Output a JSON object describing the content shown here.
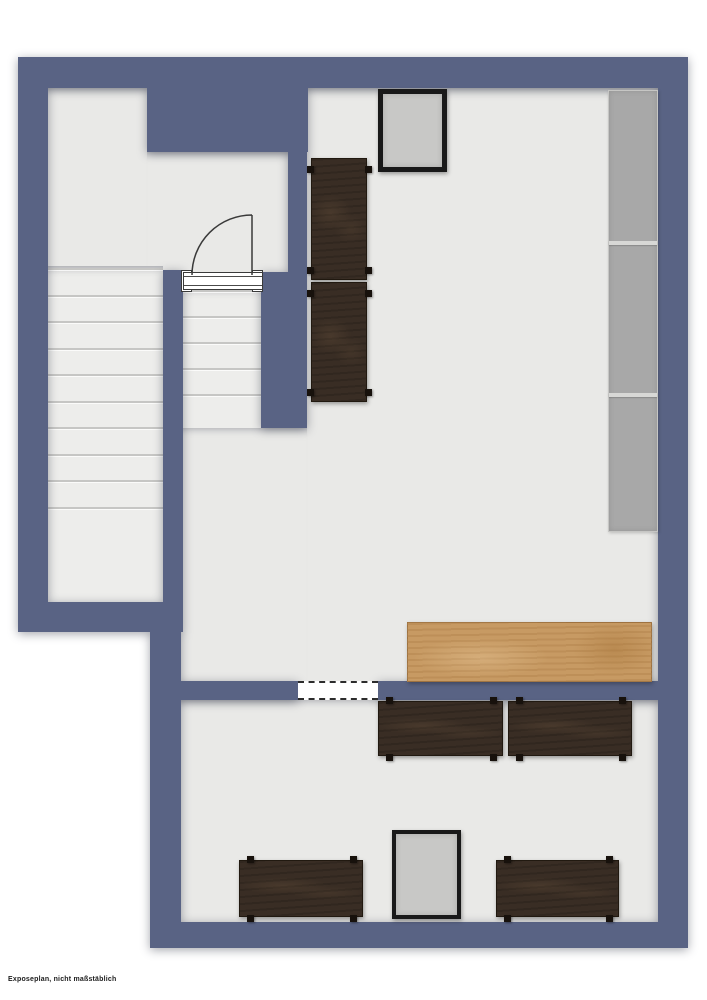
{
  "plan": {
    "disclaimer": "Exposeplan, nicht maßstäblich",
    "colors": {
      "wall": "#596384",
      "floor": "#e9e9e7",
      "stair": "#ededeb",
      "tread": "#c6c6c4",
      "shelf": "#a8a8a8",
      "darkwood": "#392d24",
      "lightwood": "#c79a63",
      "frameblack": "#191919",
      "framefill": "#c8c8c6"
    },
    "floors": [
      {
        "name": "floor-upper-left-room",
        "x": 45,
        "y": 88,
        "w": 102,
        "h": 184
      },
      {
        "name": "floor-upper-left-room-right",
        "x": 147,
        "y": 152,
        "w": 141,
        "h": 120
      },
      {
        "name": "floor-main-room",
        "x": 307,
        "y": 88,
        "w": 351,
        "h": 594
      },
      {
        "name": "floor-hall",
        "x": 181,
        "y": 428,
        "w": 126,
        "h": 254
      },
      {
        "name": "floor-bottom-room",
        "x": 181,
        "y": 700,
        "w": 477,
        "h": 222
      }
    ],
    "walls": [
      {
        "name": "outer-wall-top",
        "x": 18,
        "y": 57,
        "w": 670,
        "h": 31
      },
      {
        "name": "wall-top-notch",
        "x": 147,
        "y": 57,
        "w": 161,
        "h": 95
      },
      {
        "name": "outer-wall-left-upper",
        "x": 18,
        "y": 57,
        "w": 30,
        "h": 575
      },
      {
        "name": "wall-stair-divider",
        "x": 163,
        "y": 270,
        "w": 20,
        "h": 362
      },
      {
        "name": "wall-stair-bottom",
        "x": 18,
        "y": 602,
        "w": 163,
        "h": 30
      },
      {
        "name": "outer-wall-left-lower",
        "x": 150,
        "y": 632,
        "w": 31,
        "h": 316
      },
      {
        "name": "wall-mid-vertical",
        "x": 288,
        "y": 152,
        "w": 19,
        "h": 126
      },
      {
        "name": "wall-midstair-right",
        "x": 261,
        "y": 272,
        "w": 46,
        "h": 156
      },
      {
        "name": "outer-wall-right",
        "x": 658,
        "y": 57,
        "w": 30,
        "h": 891
      },
      {
        "name": "outer-wall-bottom",
        "x": 150,
        "y": 922,
        "w": 538,
        "h": 26
      },
      {
        "name": "wall-bottomroom-top-left",
        "x": 181,
        "y": 681,
        "w": 117,
        "h": 19
      },
      {
        "name": "wall-bottomroom-top-right",
        "x": 378,
        "y": 681,
        "w": 280,
        "h": 19
      }
    ],
    "stairs": [
      {
        "name": "stairs-left",
        "x": 48,
        "y": 266,
        "w": 115,
        "h": 336,
        "treads": 10,
        "spacing": 26.5
      },
      {
        "name": "stairs-middle",
        "x": 181,
        "y": 288,
        "w": 80,
        "h": 140,
        "treads": 5,
        "spacing": 26
      }
    ],
    "door": {
      "name": "door-upper-room",
      "posts": [
        {
          "x": 181,
          "y": 270,
          "w": 11,
          "h": 22
        },
        {
          "x": 252,
          "y": 270,
          "w": 11,
          "h": 22
        }
      ],
      "frame": {
        "x": 183,
        "y": 272,
        "w": 80,
        "h": 18
      },
      "swing": {
        "x": 190,
        "y": 213,
        "size": 64
      }
    },
    "opening": {
      "name": "opening-bottom-room",
      "x": 298,
      "y": 681,
      "w": 80,
      "h": 19
    },
    "shelf": {
      "name": "shelf-unit-right",
      "x": 608,
      "y": 90,
      "w": 50,
      "h": 442,
      "dividers": [
        150,
        302
      ]
    },
    "tables": [
      {
        "name": "dark-table-upper-1",
        "x": 311,
        "y": 158,
        "w": 56,
        "h": 122,
        "o": "v"
      },
      {
        "name": "dark-table-upper-2",
        "x": 311,
        "y": 282,
        "w": 56,
        "h": 120,
        "o": "v"
      },
      {
        "name": "dark-table-mid-1",
        "x": 378,
        "y": 701,
        "w": 125,
        "h": 55,
        "o": "h"
      },
      {
        "name": "dark-table-mid-2",
        "x": 508,
        "y": 701,
        "w": 124,
        "h": 55,
        "o": "h"
      },
      {
        "name": "dark-table-bottom-1",
        "x": 239,
        "y": 860,
        "w": 124,
        "h": 57,
        "o": "h"
      },
      {
        "name": "dark-table-bottom-2",
        "x": 496,
        "y": 860,
        "w": 123,
        "h": 57,
        "o": "h"
      }
    ],
    "counter": {
      "name": "wood-counter",
      "x": 407,
      "y": 622,
      "w": 245,
      "h": 60
    },
    "frames": [
      {
        "name": "display-frame-top",
        "x": 378,
        "y": 89,
        "w": 69,
        "h": 83,
        "border": 5
      },
      {
        "name": "display-frame-bottom",
        "x": 392,
        "y": 830,
        "w": 69,
        "h": 89,
        "border": 4
      }
    ]
  }
}
